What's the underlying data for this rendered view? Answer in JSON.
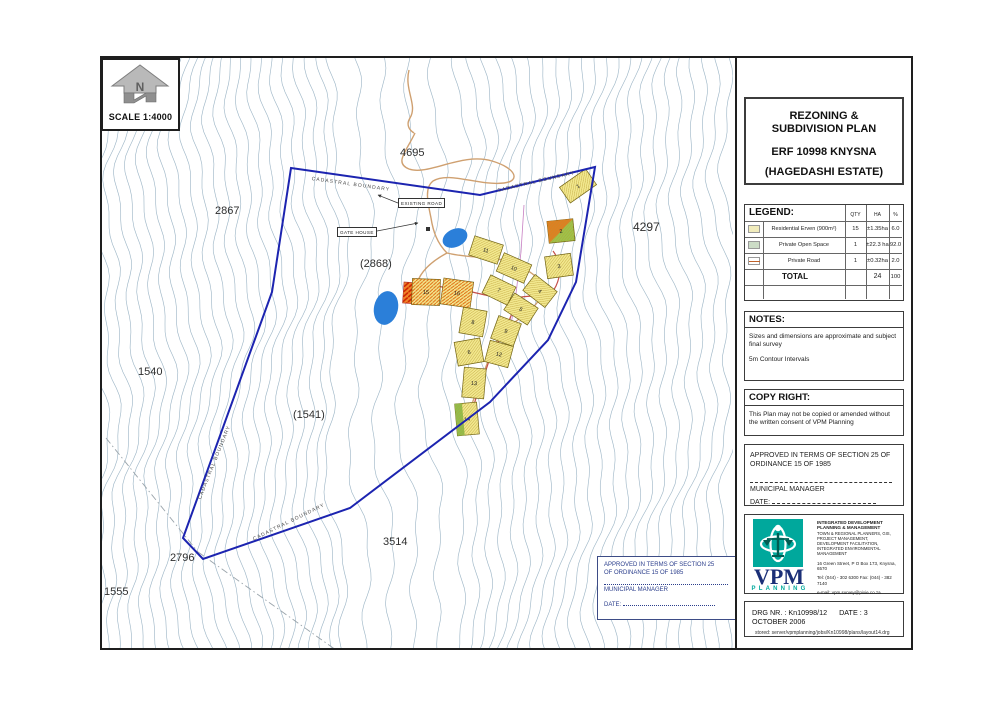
{
  "north": {
    "scale_label": "SCALE 1:4000"
  },
  "title_block": {
    "line1": "REZONING & SUBDIVISION PLAN",
    "line2": "ERF 10998 KNYSNA",
    "line3": "(HAGEDASHI ESTATE)"
  },
  "legend": {
    "header": "LEGEND:",
    "columns": {
      "qty": "QTY",
      "ha": "HA",
      "pct": "%"
    },
    "rows": [
      {
        "swatch": "residential-erven",
        "label": "Residential Erven  (900m²)",
        "qty": "15",
        "ha": "±1.35ha",
        "pct": "6.0"
      },
      {
        "swatch": "private-open-space",
        "label": "Private Open Space",
        "qty": "1",
        "ha": "±22.3 ha",
        "pct": "92.0"
      },
      {
        "swatch": "private-road",
        "label": "Private Road",
        "qty": "1",
        "ha": "±0.32ha",
        "pct": "2.0"
      }
    ],
    "total_label": "TOTAL",
    "total_ha": "24",
    "total_pct": "100"
  },
  "notes": {
    "header": "NOTES:",
    "note1": "Sizes and dimensions are approximate and subject final survey",
    "note2": "5m Contour Intervals"
  },
  "copyright": {
    "header": "COPY RIGHT:",
    "body": "This Plan may not be copied or amended without the written consent of VPM Planning"
  },
  "approval_panel": {
    "line1": "APPROVED IN TERMS OF SECTION 25 OF",
    "line2": "ORDINANCE 15 OF 1985",
    "signatory": "MUNICIPAL MANAGER",
    "date_label": "DATE:"
  },
  "firm": {
    "name": "VPM",
    "sub": "PLANNING",
    "tagline": "INTEGRATED DEVELOPMENT PLANNING & MANAGEMENT",
    "services": "TOWN & REGIONAL PLANNERS, GIS, PROJECT MANAGEMENT, DEVELOPMENT FACILITATION, INTEGRATED ENVIRONMENTAL MANAGEMENT",
    "address": "16 Green Street,   P O Box 173,   Knysna,   6570",
    "phone": "Tel: (044) - 302 6300     Fax: (044) - 382 7140",
    "email": "e-mail: vpm.survey@pixie.co.za"
  },
  "drg": {
    "number_line": "DRG NR. : Kn10998/12",
    "date_line": "DATE : 3 OCTOBER 2006",
    "stored_line": "stored: server/vpmplanning/jobs/Kn10998/plans/layout14.drg"
  },
  "map": {
    "colors": {
      "contour": "#a0b8c8",
      "boundary": "#1c24b0",
      "road_tan": "#cfa070",
      "road_red": "#c4504a",
      "pond": "#2b7fd9",
      "plot_fill": "#f2e88f",
      "plot_hatch": "#b89b30",
      "plot_green": "#9cc34b",
      "plot_orange": "#f08428",
      "dashline": "#9aa4ab",
      "utility": "#c77fc2"
    },
    "approval_box": {
      "line1": "APPROVED IN TERMS OF SECTION 25",
      "line2": "OF ORDINANCE 15 OF 1985",
      "signatory": "MUNICIPAL MANAGER",
      "date_label": "DATE:"
    },
    "boundary": [
      [
        291,
        168
      ],
      [
        480,
        195
      ],
      [
        595,
        167
      ],
      [
        576,
        282
      ],
      [
        548,
        340
      ],
      [
        490,
        402
      ],
      [
        350,
        508
      ],
      [
        203,
        559
      ],
      [
        183,
        538
      ],
      [
        272,
        292
      ]
    ],
    "ponds": [
      {
        "cx": 455,
        "cy": 238,
        "rx": 13,
        "ry": 9,
        "rot": -25
      },
      {
        "cx": 386,
        "cy": 308,
        "rx": 12,
        "ry": 17,
        "rot": 12
      }
    ],
    "roads_tan": [
      "M409,70 C404,90 418,105 410,118 C405,126 411,131 414,133",
      "M415,133 C406,152 394,163 409,169 C428,176 462,152 492,161 C516,168 521,181 504,183 C478,186 449,171 433,181 C424,188 428,203 431,218 C433,231 437,243 447,253",
      "M447,253 C472,259 497,256 512,263 C532,271 546,281 541,296 C532,316 508,321 497,341 C487,361 481,381 473,401 C469,416 466,426 471,433",
      "M447,253 C432,261 421,271 417,283"
    ],
    "roads_red": [
      "M417,283 L468,291 C490,296 506,301 516,298 C536,293 549,301 556,286 C563,271 559,259 553,251",
      "M516,299 C511,324 497,341 489,361 C481,386 473,401 471,421"
    ],
    "steep_road": {
      "x": 404,
      "y": 282,
      "w": 26,
      "h": 21,
      "rot": 4
    },
    "plots": [
      {
        "n": "1",
        "x": 578,
        "y": 186,
        "r": -35,
        "w": 32,
        "h": 19,
        "v": "y"
      },
      {
        "n": "2",
        "x": 561,
        "y": 231,
        "r": -6,
        "w": 26,
        "h": 22,
        "v": "g"
      },
      {
        "n": "3",
        "x": 559,
        "y": 266,
        "r": -8,
        "w": 26,
        "h": 22,
        "v": "y"
      },
      {
        "n": "4",
        "x": 540,
        "y": 291,
        "r": 38,
        "w": 28,
        "h": 20,
        "v": "y"
      },
      {
        "n": "5",
        "x": 521,
        "y": 309,
        "r": 33,
        "w": 28,
        "h": 20,
        "v": "y"
      },
      {
        "n": "10",
        "x": 514,
        "y": 268,
        "r": 24,
        "w": 30,
        "h": 20,
        "v": "y"
      },
      {
        "n": "11",
        "x": 486,
        "y": 250,
        "r": 18,
        "w": 30,
        "h": 20,
        "v": "y"
      },
      {
        "n": "7",
        "x": 499,
        "y": 290,
        "r": 26,
        "w": 28,
        "h": 20,
        "v": "y"
      },
      {
        "n": "8",
        "x": 473,
        "y": 322,
        "r": 10,
        "w": 24,
        "h": 26,
        "v": "y"
      },
      {
        "n": "9",
        "x": 506,
        "y": 331,
        "r": 20,
        "w": 24,
        "h": 24,
        "v": "y"
      },
      {
        "n": "6",
        "x": 469,
        "y": 352,
        "r": -10,
        "w": 26,
        "h": 24,
        "v": "y"
      },
      {
        "n": "12",
        "x": 499,
        "y": 354,
        "r": 15,
        "w": 24,
        "h": 22,
        "v": "y"
      },
      {
        "n": "13",
        "x": 474,
        "y": 383,
        "r": 5,
        "w": 22,
        "h": 30,
        "v": "y"
      },
      {
        "n": "14",
        "x": 467,
        "y": 419,
        "r": -5,
        "w": 22,
        "h": 32,
        "v": "g2"
      },
      {
        "n": "15",
        "x": 426,
        "y": 292,
        "r": 2,
        "w": 28,
        "h": 26,
        "v": "o"
      },
      {
        "n": "16",
        "x": 457,
        "y": 293,
        "r": 8,
        "w": 30,
        "h": 26,
        "v": "o"
      }
    ],
    "labels": [
      {
        "t": "4695",
        "x": 400,
        "y": 147,
        "s": 11,
        "r": 0
      },
      {
        "t": "2867",
        "x": 215,
        "y": 205,
        "s": 11,
        "r": 0
      },
      {
        "t": "(2868)",
        "x": 360,
        "y": 258,
        "s": 11,
        "r": 0
      },
      {
        "t": "4297",
        "x": 633,
        "y": 220,
        "s": 12,
        "r": 0
      },
      {
        "t": "1540",
        "x": 138,
        "y": 366,
        "s": 11,
        "r": 0
      },
      {
        "t": "(1541)",
        "x": 293,
        "y": 409,
        "s": 11,
        "r": 0
      },
      {
        "t": "2796",
        "x": 170,
        "y": 552,
        "s": 11,
        "r": 0
      },
      {
        "t": "1555",
        "x": 104,
        "y": 586,
        "s": 11,
        "r": 0
      },
      {
        "t": "3514",
        "x": 383,
        "y": 536,
        "s": 11,
        "r": 0
      },
      {
        "t": "CADASTRAL BOUNDARY",
        "x": 312,
        "y": 176,
        "s": 5,
        "r": 8
      },
      {
        "t": "CADASTRAL BOUNDARY",
        "x": 497,
        "y": 188,
        "s": 5,
        "r": -13
      },
      {
        "t": "CADASTRAL BOUNDARY",
        "x": 197,
        "y": 498,
        "s": 5,
        "r": -68
      },
      {
        "t": "CADASTRAL BOUNDARY",
        "x": 252,
        "y": 537,
        "s": 5,
        "r": -26
      }
    ],
    "boxed_labels": [
      {
        "text": "EXISTING ROAD",
        "x": 398,
        "y": 198
      },
      {
        "text": "GATE HOUSE",
        "x": 337,
        "y": 227
      }
    ],
    "leaders": [
      [
        398,
        203,
        378,
        195
      ],
      [
        377,
        231,
        418,
        223
      ]
    ],
    "dash_lines": [
      "M106,438 L198,552",
      "M198,552 L336,650"
    ],
    "utility": "M524,205 L521,252 L515,302 L508,341"
  }
}
